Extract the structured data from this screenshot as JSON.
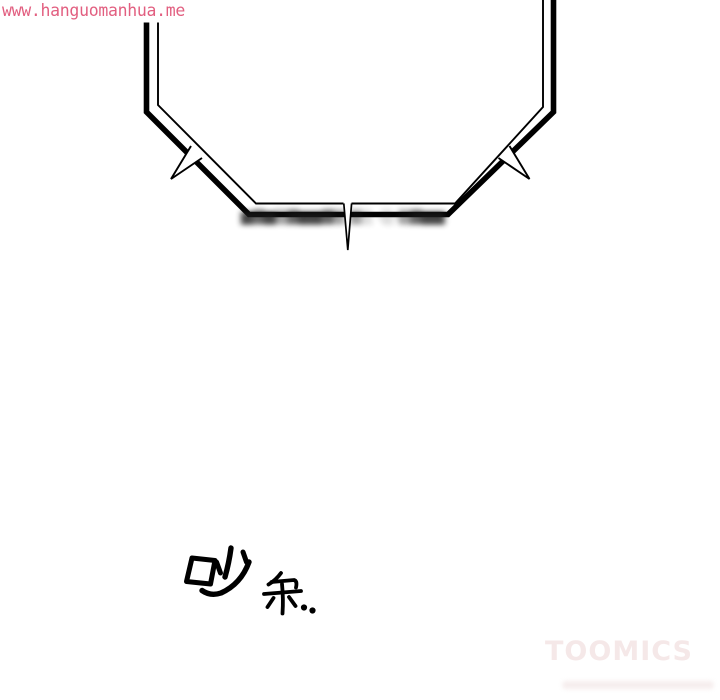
{
  "page": {
    "background": "#ffffff",
    "type": "webtoon-comic-panel"
  },
  "watermarks": {
    "site": "www.hanguomanhua.me",
    "site_color": "#e25f80",
    "toomics": "TOOMICS",
    "toomics_color": "#f5e8e8"
  },
  "bubble": {
    "description": "double-outline speech bubble, top edges run off the top of the frame, thick outer line and thin inner line, spiked tails on left and right shoulders and a thin needle tail pointing down at bottom center",
    "line_color": "#000000",
    "censored_text": "▇▓▇▒▓▇▇▓▒ ▒░ ·░·▒▓▇▇"
  },
  "sfx": {
    "large_char": "吵",
    "small_char": "杂",
    "ellipsis": "..",
    "color": "#000000"
  }
}
